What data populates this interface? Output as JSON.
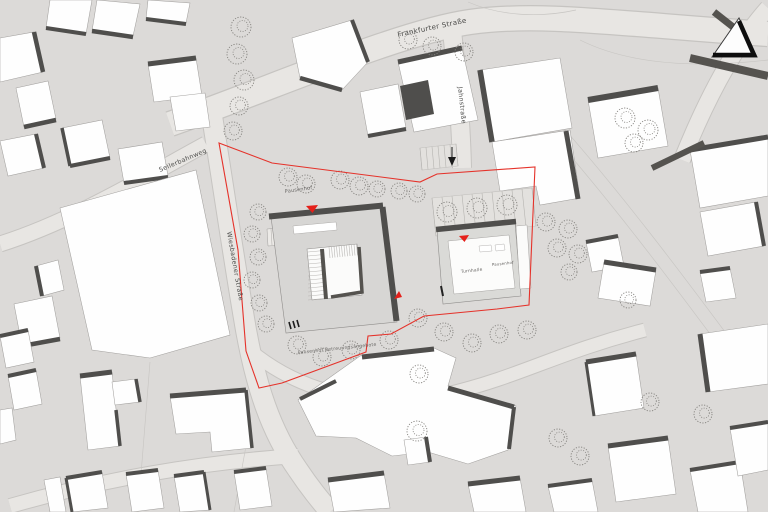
{
  "plan": {
    "title": "architectural site plan",
    "streets": {
      "frankfurter": "Frankfurter Straße",
      "seilerbahnweg": "Seilerbahnweg",
      "wiesbadener": "Wiesbadener Straße",
      "jahnstrasse": "Jahnstraße"
    },
    "site": {
      "courtyard_nw": "Pausenhof",
      "south_walk": "Pausenhof Betreuungsangebote",
      "gym": "Turnhalle",
      "gym_side": "Pausenhof"
    },
    "colors": {
      "background": "#dcdad8",
      "street": "#e8e6e3",
      "building_fill": "#fefefe",
      "building_shadow": "#4f4e4c",
      "school_roof": "#d7d6d4",
      "boundary_red": "#e5322a",
      "tree_stroke": "#84827e"
    },
    "icons": {
      "north_arrow": "north-arrow",
      "entrance_marker": "red-entrance-triangle",
      "delivery_arrow": "black-down-arrow"
    }
  }
}
